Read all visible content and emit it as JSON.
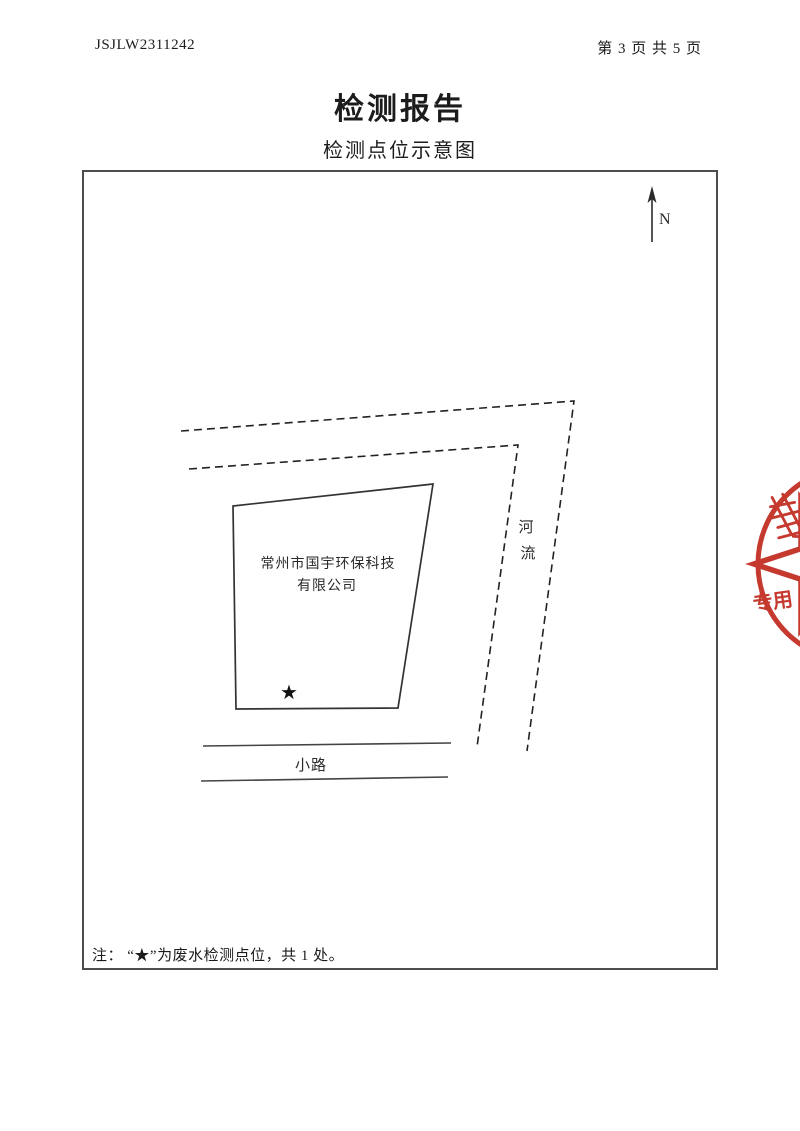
{
  "header": {
    "report_no": "JSJLW2311242",
    "page_info": "第 3 页 共 5 页"
  },
  "title": "检测报告",
  "subtitle": "检测点位示意图",
  "diagram": {
    "north_label": "N",
    "company_line1": "常州市国宇环保科技",
    "company_line2": "有限公司",
    "river_char1": "河",
    "river_char2": "流",
    "road_label": "小路",
    "marker_star": "★",
    "note": "注：  “★”为废水检测点位，共 1 处。"
  },
  "stamp": {
    "visible_text": "专用",
    "color": "#c5392f"
  }
}
